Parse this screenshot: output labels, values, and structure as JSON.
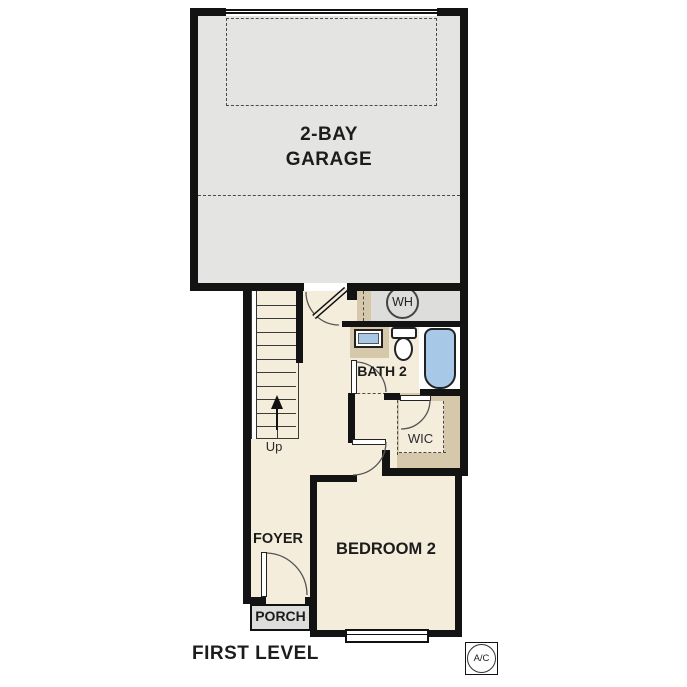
{
  "title": "FIRST LEVEL",
  "palette": {
    "floor_cream": "#f5eddc",
    "garage_gray": "#e4e4e2",
    "utility_gray": "#dddddc",
    "closet_tan": "#d6c8aa",
    "fixture_blue": "#a8c8e8",
    "wall_black": "#131313",
    "line_dark": "#3a3a3a",
    "text_dark": "#1c1c1c"
  },
  "rooms": {
    "garage_line1": "2-BAY",
    "garage_line2": "GARAGE",
    "bath": "BATH 2",
    "wic": "WIC",
    "bedroom": "BEDROOM 2",
    "foyer": "FOYER",
    "porch": "PORCH"
  },
  "labels": {
    "stairs_up": "Up",
    "water_heater": "WH",
    "air_conditioning": "A/C"
  }
}
